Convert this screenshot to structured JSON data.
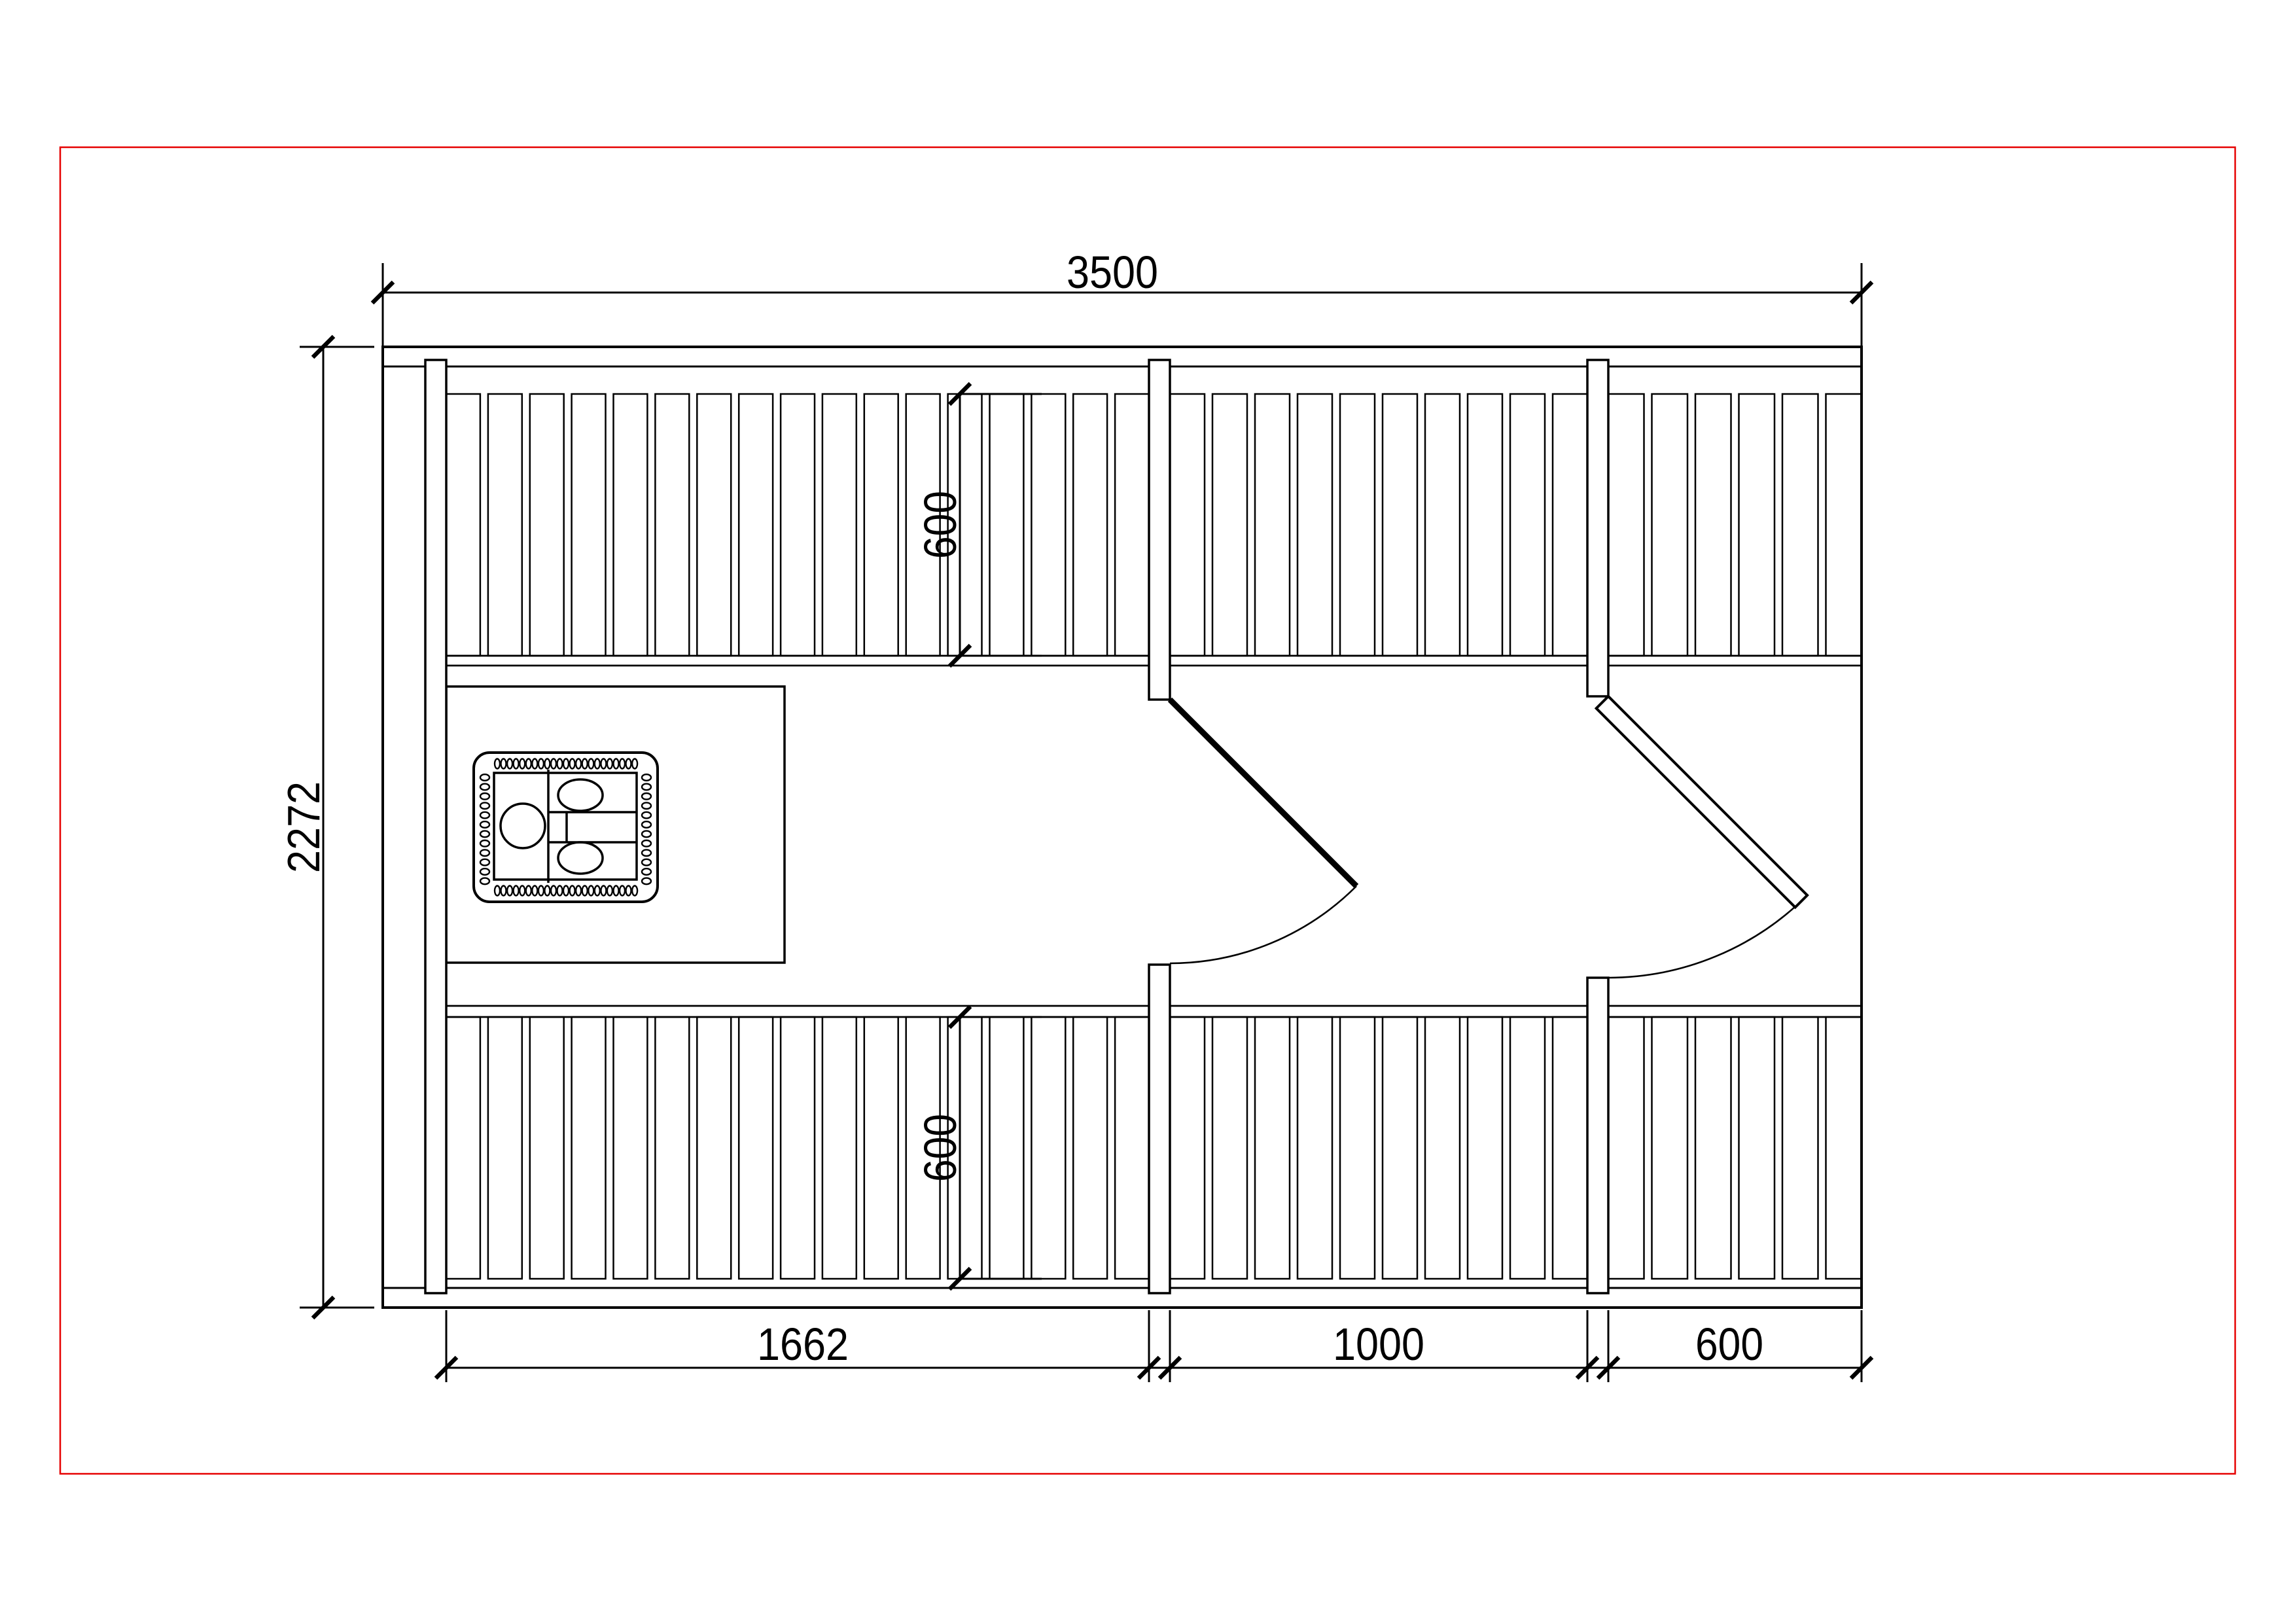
{
  "meta": {
    "drawing_type": "sauna-floor-plan"
  },
  "colors": {
    "sheet_frame": "#e60000",
    "line": "#000000",
    "background": "#ffffff"
  },
  "dimensions": {
    "overall_width": {
      "label": "3500"
    },
    "overall_depth": {
      "label": "2272"
    },
    "top_bench_depth": {
      "label": "600"
    },
    "bottom_bench_depth": {
      "label": "600"
    },
    "bottom_segments": [
      {
        "label": "1662"
      },
      {
        "label": "1000"
      },
      {
        "label": "600"
      }
    ]
  }
}
